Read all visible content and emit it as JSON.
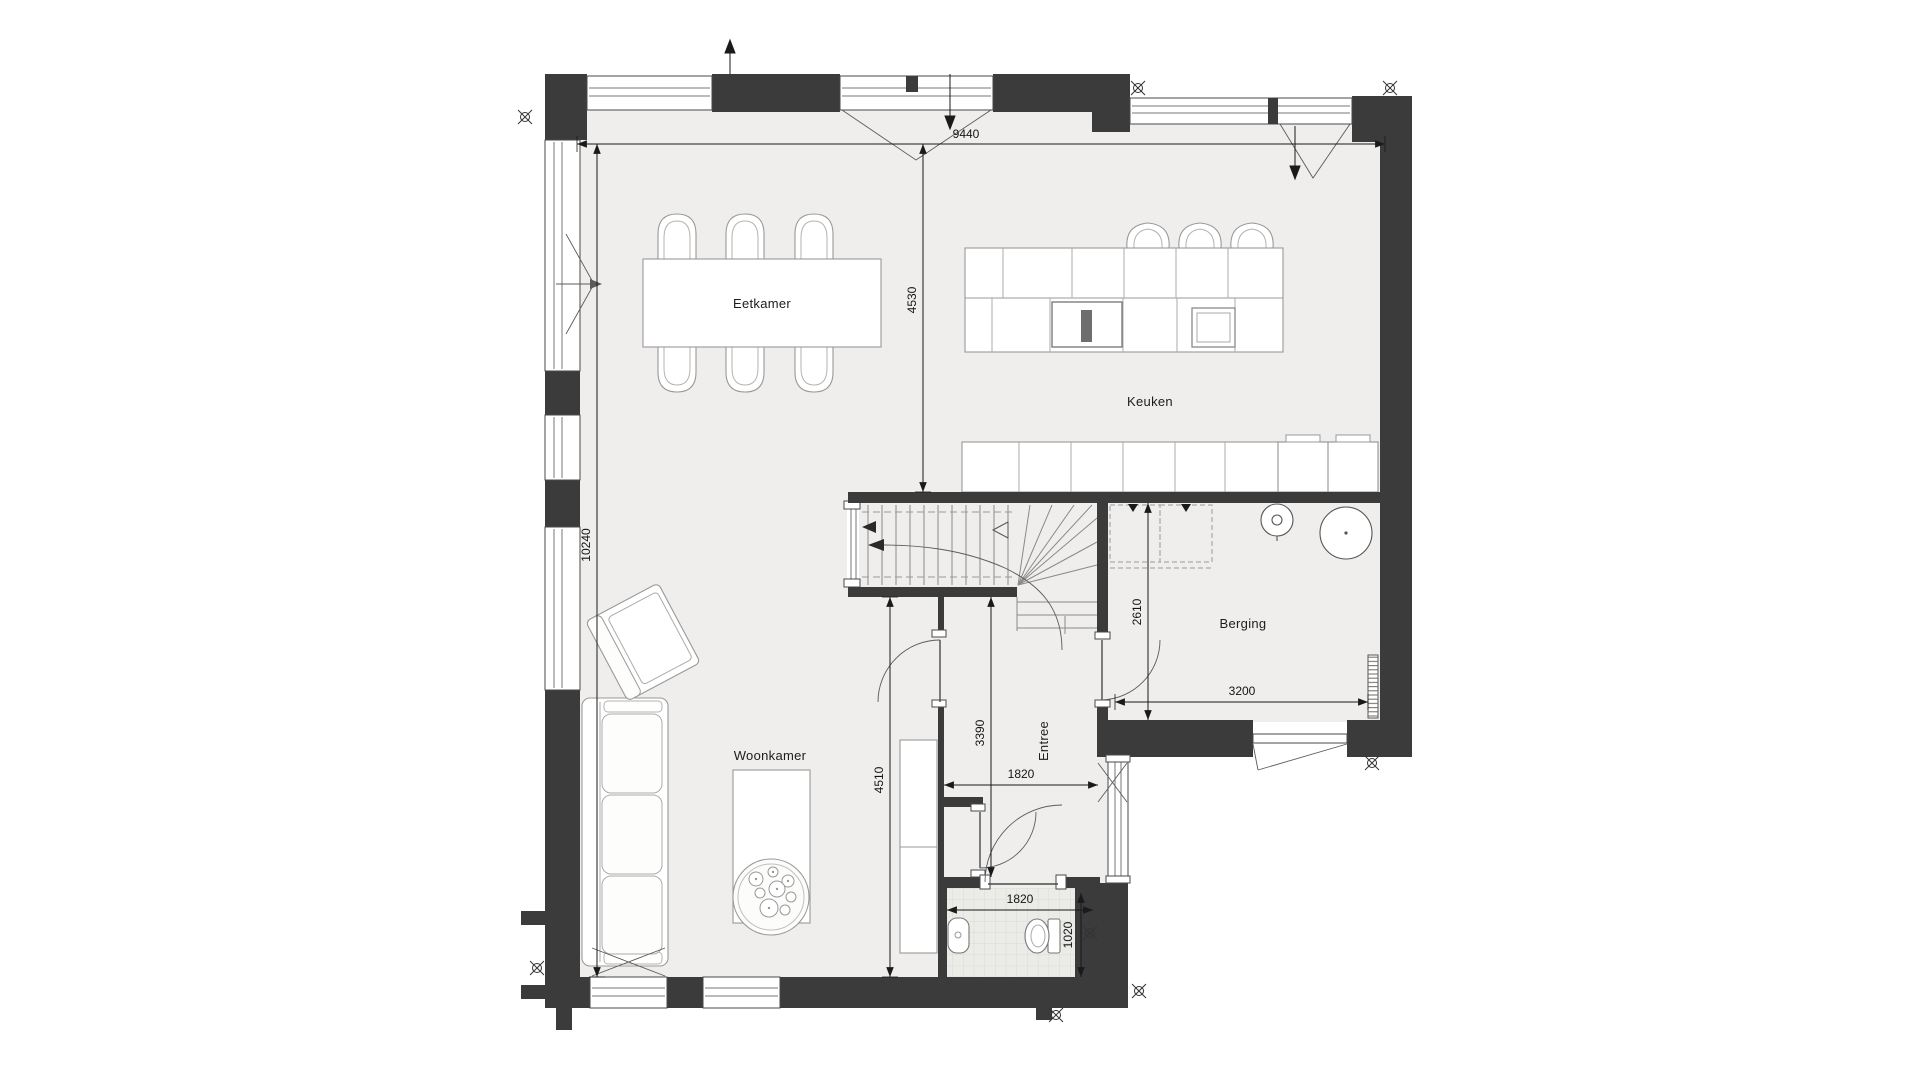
{
  "plan": {
    "type": "floor-plan",
    "floor": "ground-floor",
    "rooms": {
      "dining": "Eetkamer",
      "kitchen": "Keuken",
      "storage": "Berging",
      "hall": "Entree",
      "living": "Woonkamer"
    },
    "dimensions_mm": {
      "overall_width": "9440",
      "overall_depth": "10240",
      "dining_depth": "4530",
      "living_depth": "4510",
      "hall_length": "3390",
      "storage_depth": "2610",
      "storage_width": "3200",
      "hall_width": "1820",
      "wc_width": "1820",
      "wc_depth": "1020"
    },
    "colors": {
      "wall": "#3b3b3b",
      "floor": "#efeeec",
      "tile": "#ebebe7",
      "furniture_line": "#999999",
      "dimension": "#1a1a1a",
      "background": "#ffffff"
    },
    "icons": [
      "survey-marker-icon",
      "stair-direction-arrow-icon",
      "door-swing-icon",
      "window-opening-icon"
    ]
  }
}
